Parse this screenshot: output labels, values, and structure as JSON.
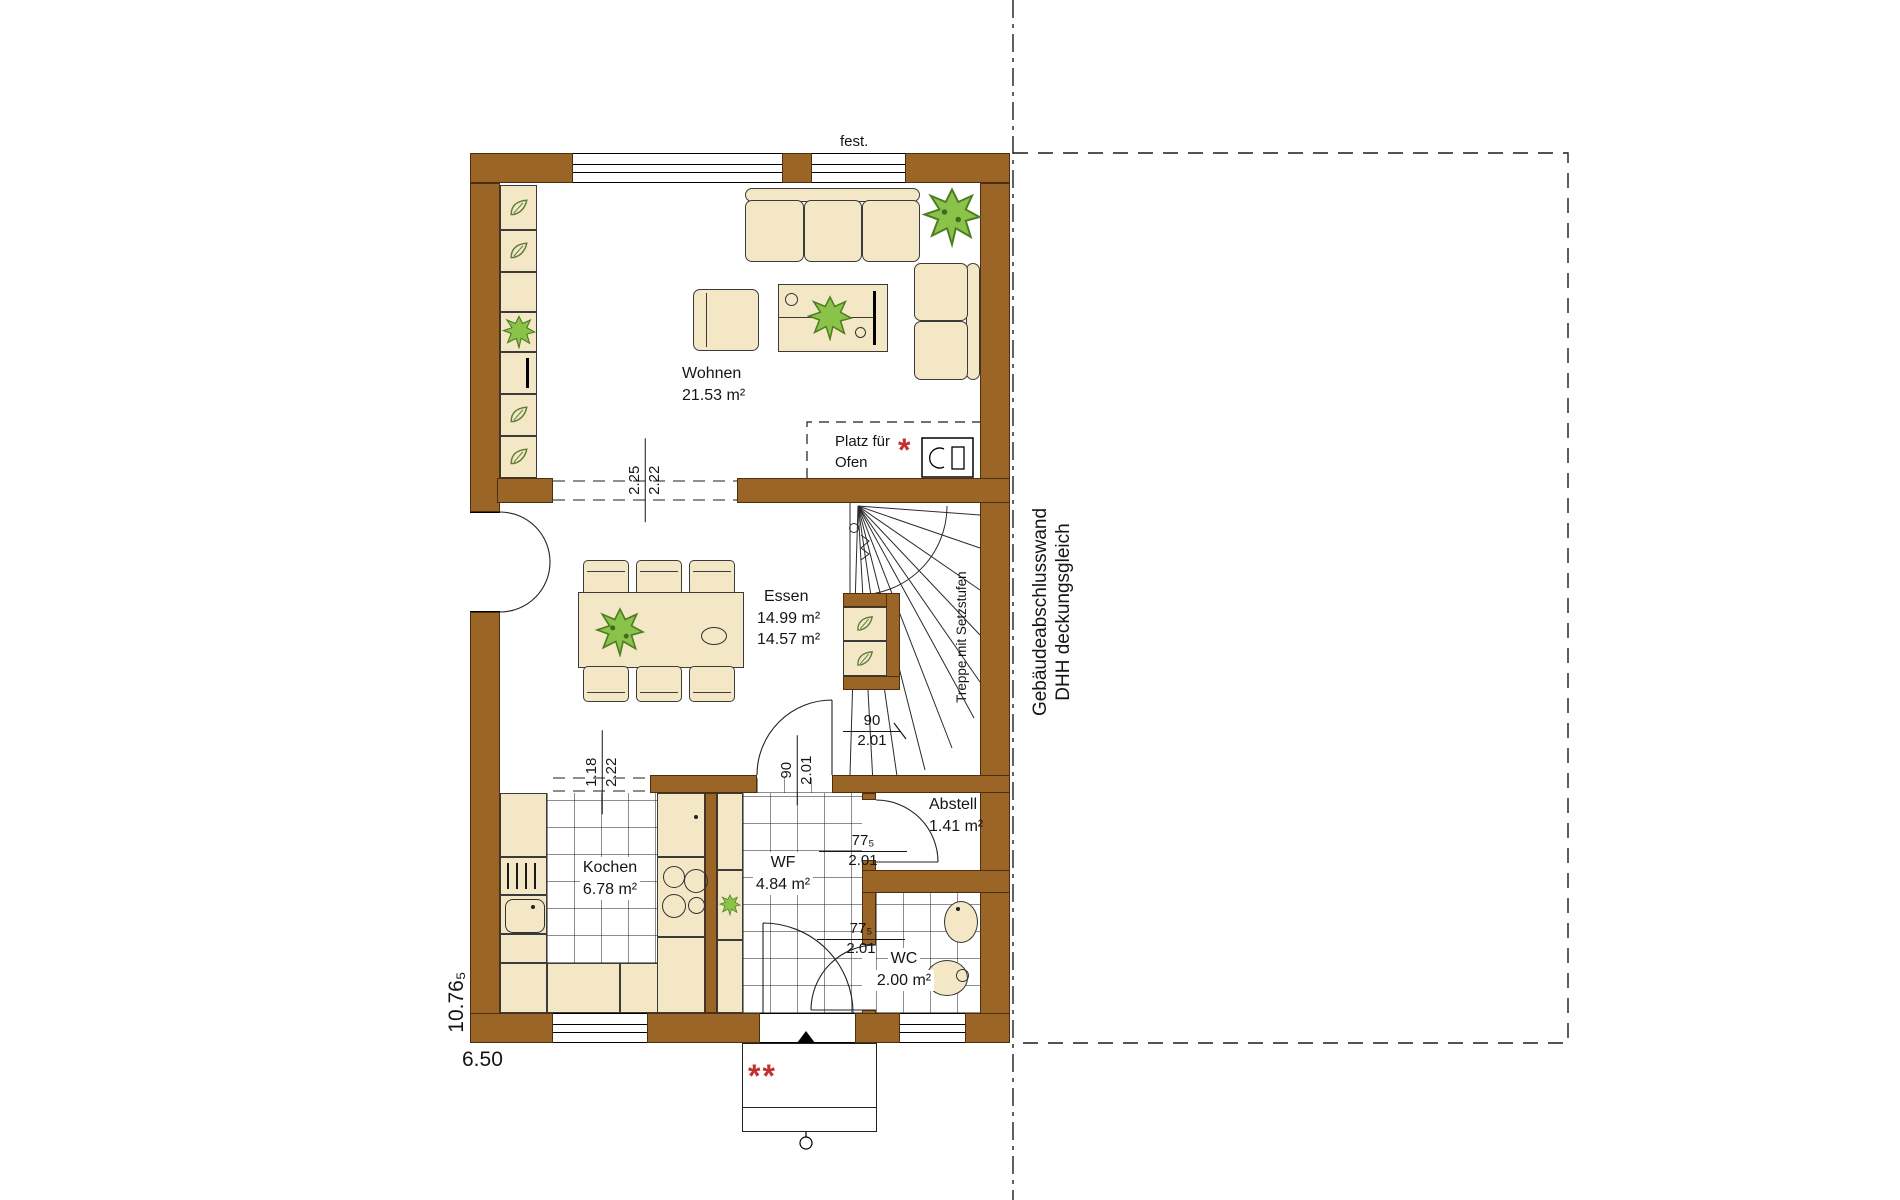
{
  "rooms": {
    "wohnen": {
      "name": "Wohnen",
      "area": "21.53 m²"
    },
    "essen": {
      "name": "Essen",
      "area_upper": "14.99 m²",
      "area_lower": "14.57 m²"
    },
    "kochen": {
      "name": "Kochen",
      "area": "6.78 m²"
    },
    "wf": {
      "name": "WF",
      "area": "4.84 m²"
    },
    "abstell": {
      "name": "Abstell",
      "area": "1.41 m²"
    },
    "wc": {
      "name": "WC",
      "area": "2.00 m²"
    }
  },
  "labels": {
    "fixed_window": "fest.",
    "stove_line1": "Platz für",
    "stove_line2": "Ofen",
    "stove_note": "*",
    "entrance_note": "**",
    "stairs": "Treppe mit Setzstufen",
    "party_wall_line1": "Gebäudeabschlusswand",
    "party_wall_line2": "DHH deckungsgleich"
  },
  "dimensions": {
    "total_width": "6.50",
    "total_depth": "10.76₅",
    "wohnen_essen_opening": {
      "width": "2.25",
      "height": "2.22"
    },
    "kochen_opening": {
      "width": "1.18",
      "height": "2.22"
    },
    "essen_door": {
      "width": "90",
      "height": "2.01"
    },
    "stair_door": {
      "width": "90",
      "height": "2.01"
    },
    "abstell_door": {
      "width": "77₅",
      "height": "2.01"
    },
    "wc_door": {
      "width": "77₅",
      "height": "2.01"
    }
  },
  "colors": {
    "wall": "#9c6528",
    "furniture_fill": "#f3e7c6",
    "plant_green": "#8bc34a",
    "note_red": "#c62f2f"
  }
}
